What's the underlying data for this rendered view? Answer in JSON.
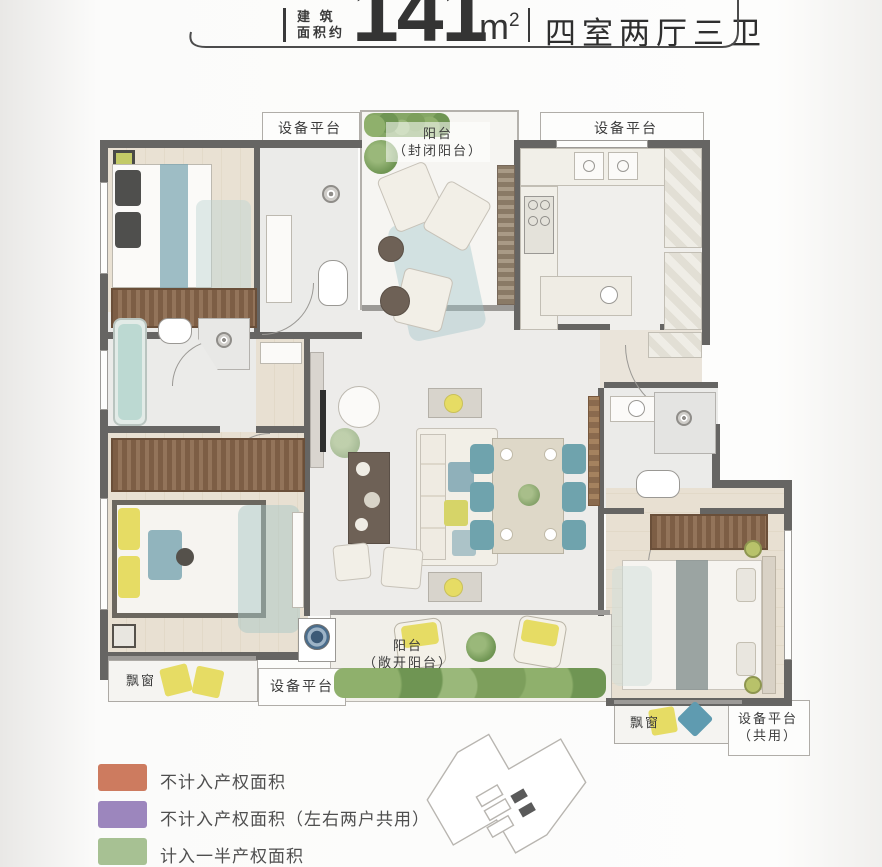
{
  "header": {
    "area_label_line1": "建 筑",
    "area_label_line2": "面积约",
    "area_value": "141",
    "area_unit": "m",
    "area_unit_sup": "2",
    "layout_type": "四室两厅三卫"
  },
  "plan": {
    "labels": {
      "equip_top_left": "设备平台",
      "balcony_top_line1": "阳台",
      "balcony_top_line2": "（封闭阳台）",
      "equip_top_right": "设备平台",
      "bay_window_left": "飘窗",
      "equip_bottom": "设备平台",
      "balcony_bottom_line1": "阳台",
      "balcony_bottom_line2": "（敞开阳台）",
      "bay_window_right": "飘窗",
      "equip_shared_line1": "设备平台",
      "equip_shared_line2": "（共用）"
    }
  },
  "legend": {
    "items": [
      {
        "color": "#cd7b5f",
        "label": "不计入产权面积"
      },
      {
        "color": "#9c86bd",
        "label": "不计入产权面积（左右两户共用）"
      },
      {
        "color": "#a7c193",
        "label": "计入一半产权面积"
      }
    ]
  }
}
